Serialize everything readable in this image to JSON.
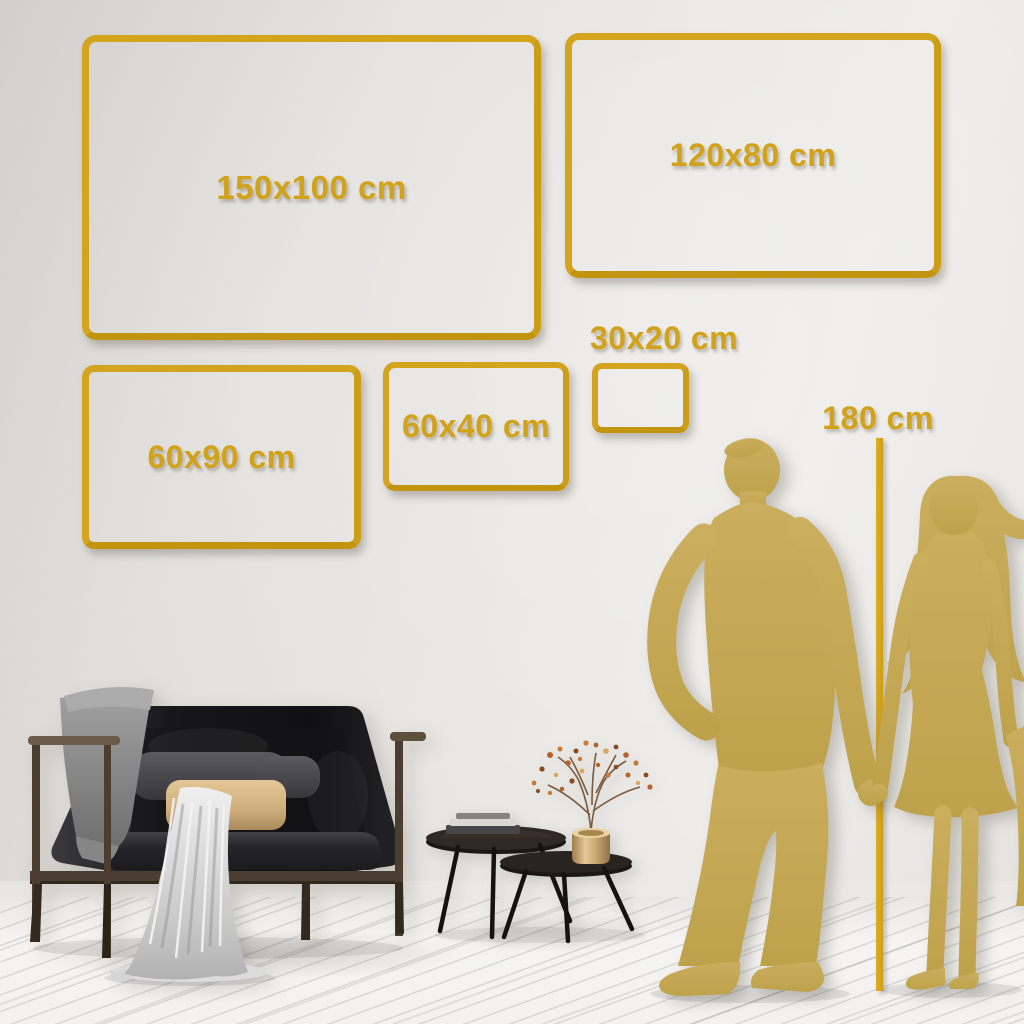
{
  "size_guide": {
    "frames": [
      {
        "id": "150x100",
        "label": "150x100 cm"
      },
      {
        "id": "120x80",
        "label": "120x80 cm"
      },
      {
        "id": "60x90",
        "label": "60x90 cm"
      },
      {
        "id": "60x40",
        "label": "60x40 cm"
      },
      {
        "id": "30x20",
        "label": "30x20 cm"
      }
    ],
    "height_reference": {
      "label": "180 cm"
    }
  },
  "colors": {
    "frame_gold": "#d4a41f",
    "label_gold": "#d2a21a",
    "silhouette_gold": "#c6a956",
    "wall": "#e7e5e2",
    "floor": "#f3f2f0",
    "sofa_black": "#1b1b1d",
    "pillow_tan": "#d5b484",
    "vase_brass": "#c9ac7e"
  },
  "scene": {
    "figures": [
      "man-silhouette",
      "woman-silhouette"
    ],
    "furniture": [
      "sofa",
      "coffee-tables",
      "vase-with-branch"
    ]
  }
}
